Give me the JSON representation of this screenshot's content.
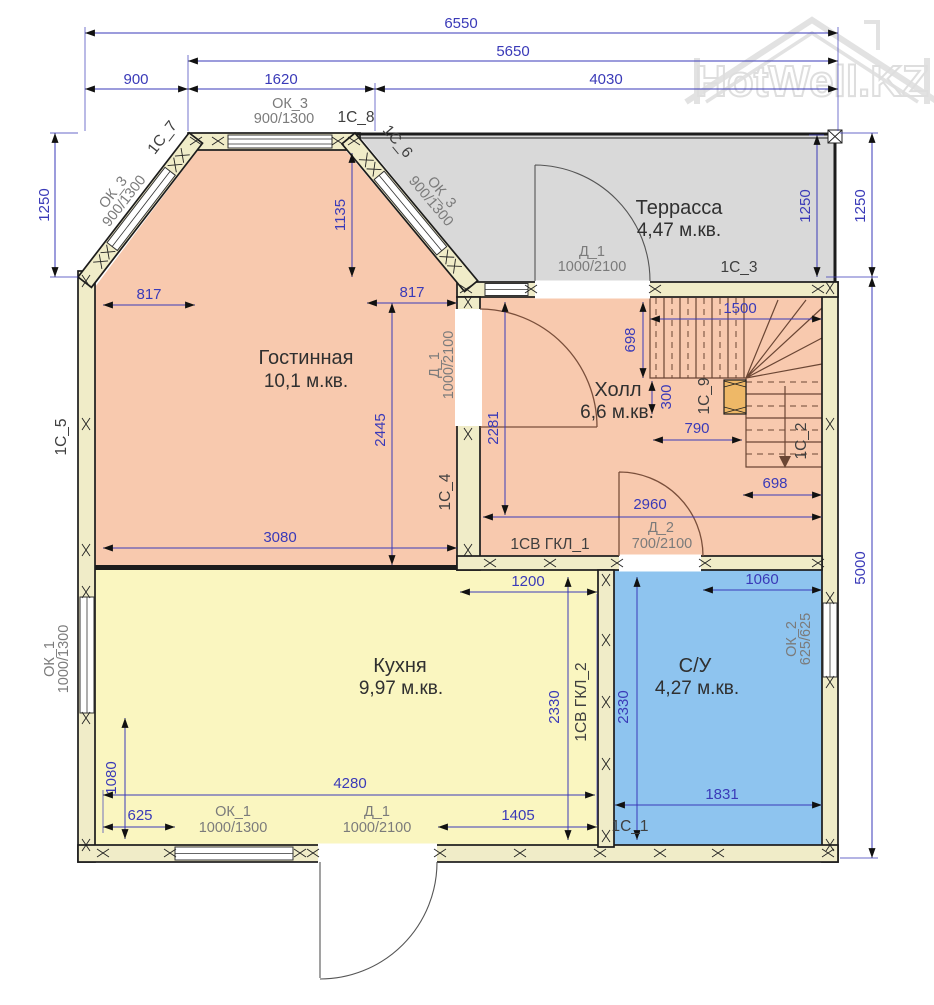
{
  "watermark": {
    "brand": "HotWell.KZ"
  },
  "rooms": {
    "terrace": {
      "name": "Террасса",
      "area": "4,47 м.кв."
    },
    "living": {
      "name": "Гостинная",
      "area": "10,1 м.кв."
    },
    "hall": {
      "name": "Холл",
      "area": "6,6 м.кв."
    },
    "kitchen": {
      "name": "Кухня",
      "area": "9,97 м.кв."
    },
    "bath": {
      "name": "С/У",
      "area": "4,27 м.кв."
    }
  },
  "dims": {
    "total_w": "6550",
    "inner_w": "5650",
    "w900": "900",
    "w1620": "1620",
    "w4030": "4030",
    "h1250": "1250",
    "h1135": "1135",
    "w817": "817",
    "h2445": "2445",
    "w3080": "3080",
    "h2281": "2281",
    "h698": "698",
    "w1500": "1500",
    "h300": "300",
    "w790": "790",
    "w2960": "2960",
    "w1200": "1200",
    "w1060": "1060",
    "h2330": "2330",
    "w1831": "1831",
    "w1405": "1405",
    "w4280": "4280",
    "h1080": "1080",
    "w625": "625",
    "h5000": "5000"
  },
  "openings": {
    "ok3": {
      "tag": "ОК_3",
      "size": "900/1300"
    },
    "ok1": {
      "tag": "ОК_1",
      "size": "1000/1300"
    },
    "ok2": {
      "tag": "ОК_2",
      "size": "625/625"
    },
    "d1": {
      "tag": "Д_1",
      "size": "1000/2100"
    },
    "d2": {
      "tag": "Д_2",
      "size": "700/2100"
    }
  },
  "panels": {
    "s1": "1С_1",
    "s2": "1С_2",
    "s3": "1С_3",
    "s4": "1С_4",
    "s5": "1С_5",
    "s6": "1С_6",
    "s7": "1С_7",
    "s8": "1С_8",
    "s9": "1С_9",
    "gkl1": "1СВ ГКЛ_1",
    "gkl2": "1СВ ГКЛ_2"
  },
  "colors": {
    "living": "#f8c9ae",
    "kitchen": "#faf6c0",
    "bath": "#8ec4ef",
    "terrace": "#d9d9d9",
    "wall": "#f0ecc8",
    "newel": "#eeb867",
    "dim": "#3a3ab8"
  }
}
